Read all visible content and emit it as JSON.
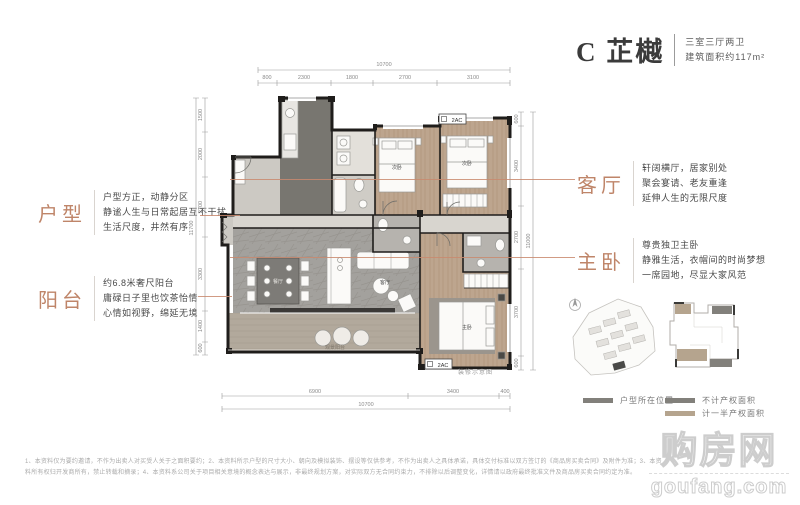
{
  "header": {
    "name": "C 芷樾",
    "spec": "三室三厅两卫",
    "area": "建筑面积约117m²"
  },
  "annotations": {
    "huxing": {
      "label": "户型",
      "lines": [
        "户型方正，动静分区",
        "静谧人生与日常起居互不干扰",
        "生活尺度，井然有序"
      ]
    },
    "yangtai": {
      "label": "阳台",
      "lines": [
        "约6.8米奢尺阳台",
        "庸碌日子里也饮茶怡情",
        "心情如视野，绵延无境"
      ]
    },
    "keting": {
      "label": "客厅",
      "lines": [
        "轩阔横厅，居家别处",
        "聚会宴请、老友重逢",
        "延伸人生的无限尺度"
      ]
    },
    "zhuwo": {
      "label": "主卧",
      "lines": [
        "尊贵独卫主卧",
        "静雅生活，衣帽间的时尚梦想",
        "一席园地，尽显大家风范"
      ]
    }
  },
  "floorplan": {
    "caption": "装修示意图",
    "ac_label": "2AC",
    "room_labels": {
      "dining": "餐厅",
      "living": "客厅",
      "bedroom2": "次卧",
      "bedroom3": "次卧",
      "master": "主卧",
      "balcony": "观景阳台"
    },
    "dims": {
      "top_total": "10700",
      "top_segments": [
        "800",
        "2300",
        "1800",
        "2700",
        "3100"
      ],
      "left_total": "11700",
      "left_segments": [
        "1500",
        "2000",
        "2700",
        "3300",
        "1400",
        "600"
      ],
      "right_total": "11000",
      "right_segments": [
        "600",
        "3400",
        "2700",
        "3700",
        "600"
      ],
      "bottom_segments": [
        "6900",
        "3400",
        "400"
      ],
      "bottom_total": "10700"
    }
  },
  "legend": {
    "location_label": "户型所在位置",
    "excluded_label": "不计产权面积",
    "half_label": "计一半产权面积",
    "excluded_color": "#82807b",
    "half_color": "#b5a48e"
  },
  "disclaimer": {
    "line1": "1、本资料仅为要约邀请，不作为出卖人对买受人关于之面积要约；2、本资料所示户型的尺寸大小、朝向及模拟装饰、摆设等仅供参考，不作为出卖人之具体承诺，具体交付标准以双方签订的《商品房买卖合同》及附件为准；3、本资",
    "line2": "料所有权归开发商所有，禁止转载和摘录；4、本资料系公司关于项目相关意境的概念表达与展示，非最终规划方案，对实际双方无合同约束力，不排除以后调整变化，详情请以政府最终批准文件及商品房买卖合同约定为准。"
  },
  "watermark": {
    "name": "购房网",
    "domain": "goufang.com"
  },
  "colors": {
    "accent": "#bf8569",
    "connector": "#c98a6e",
    "wall": "#1f1d1b",
    "wood": "#bda58e",
    "gray_floor": "#a3a19d",
    "balcony": "#b2a99c"
  }
}
